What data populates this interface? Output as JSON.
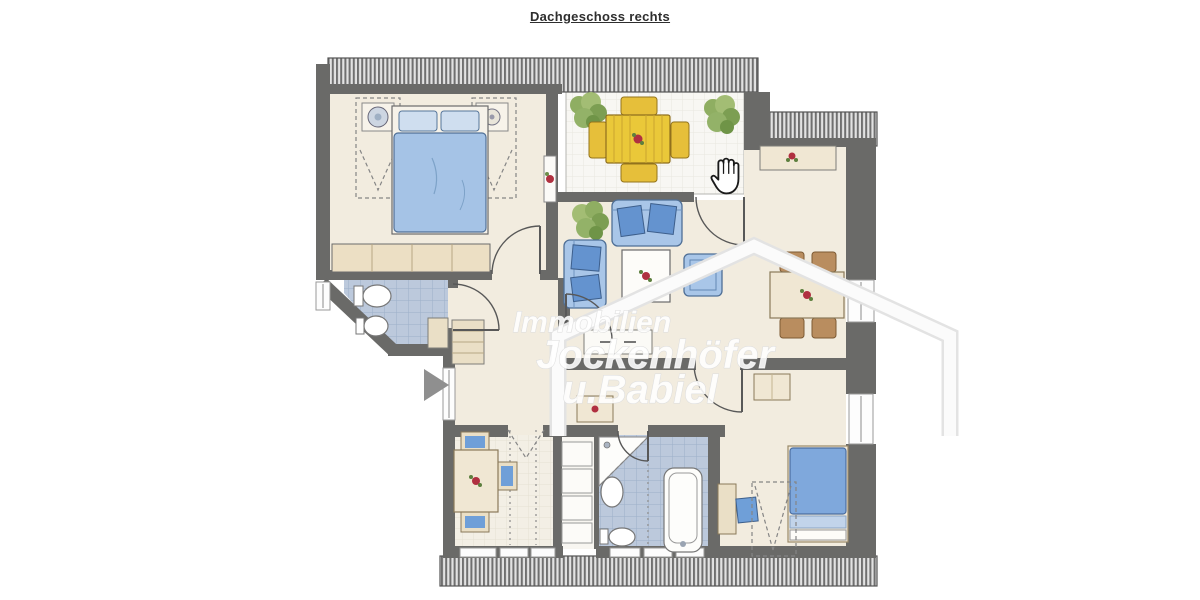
{
  "page": {
    "title": "Dachgeschoss rechts"
  },
  "watermark": {
    "line1": "Immobilien",
    "line2": "Jockenhöfer",
    "line3": "u.Babiel"
  },
  "viewer": {
    "next_arrow_icon": "right-triangle",
    "hand_cursor_icon": "open-hand"
  },
  "colors": {
    "wall": "#6a6a68",
    "floor_cream": "#f2ecdf",
    "balcony_floor": "#f8f7f3",
    "tile_blue": "#bcc9dc",
    "furniture_blue": "#a9c6e8",
    "cushion_blue": "#6493cf",
    "balcony_table_yellow": "#eac839",
    "wood_beige": "#f0e7d3",
    "chair_brown": "#b98d5f",
    "plant_green": "#83a85c",
    "flower_red": "#b03040",
    "hatch_gray": "#707070",
    "watermark_white": "#ffffff",
    "arrow_gray": "#8f8f8f"
  }
}
